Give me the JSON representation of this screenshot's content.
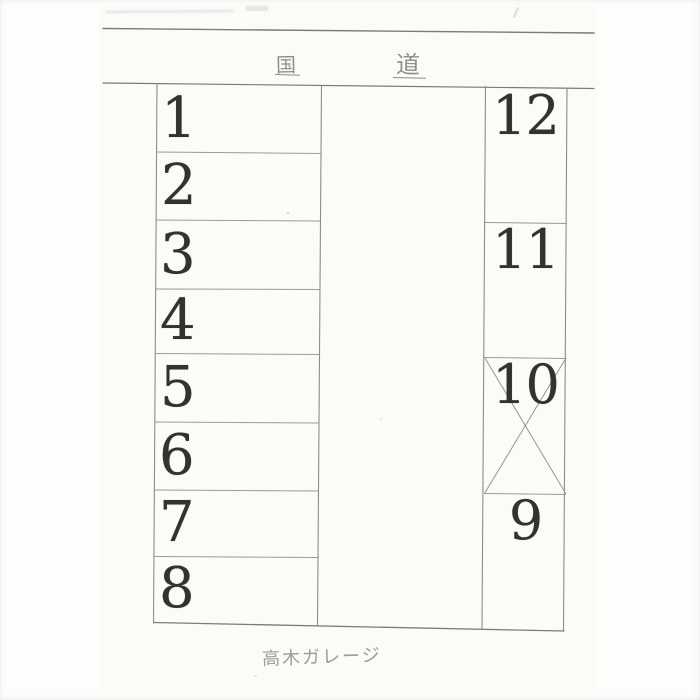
{
  "page": {
    "road_label": {
      "left_char": "国",
      "right_char": "道"
    },
    "caption": "高木ガレージ",
    "left_spaces": [
      {
        "label": "1"
      },
      {
        "label": "2"
      },
      {
        "label": "3"
      },
      {
        "label": "4"
      },
      {
        "label": "5"
      },
      {
        "label": "6"
      },
      {
        "label": "7"
      },
      {
        "label": "8"
      }
    ],
    "right_spaces": [
      {
        "label": "12",
        "crossed": false
      },
      {
        "label": "11",
        "crossed": false
      },
      {
        "label": "10",
        "crossed": true
      },
      {
        "label": "9",
        "crossed": false
      }
    ]
  }
}
